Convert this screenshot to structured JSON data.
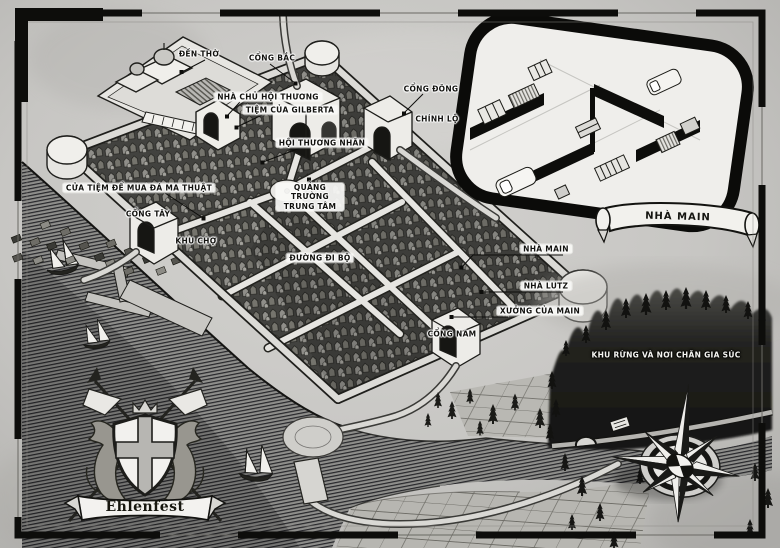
{
  "map": {
    "title_banner": "Ehlenfest",
    "inset_banner": "NHÀ MAIN",
    "labels": {
      "temple": "ĐỀN THỜ",
      "north_gate": "CỔNG BẮC",
      "guildmaster_house": "NHÀ CHỦ HỘI THƯƠNG",
      "gilberta_shop": "TIỆM CỦA GILBERTA",
      "merchant_guild": "HỘI THƯƠNG NHÂN",
      "east_gate": "CỔNG ĐÔNG",
      "main_road": "CHÍNH LỘ",
      "magic_stone_shop": "CỬA TIỆM ĐỂ MUA ĐÁ MA THUẬT",
      "west_gate": "CỔNG TÂY",
      "market": "KHU CHỢ",
      "central_plaza": "QUẢNG TRƯỜNG TRUNG TÂM",
      "walking_street": "ĐƯỜNG ĐI BỘ",
      "main_house": "NHÀ MAIN",
      "lutz_house": "NHÀ LUTZ",
      "main_workshop": "XƯỞNG CỦA MAIN",
      "south_gate": "CỔNG NAM",
      "forest": "KHU RỪNG VÀ NƠI CHĂN GIA SÚC"
    },
    "colors": {
      "paper": "#c7c6c3",
      "ink": "#131310",
      "forest": "#161614",
      "river": "#8e8e8b",
      "highlight": "#f2f1ed"
    }
  }
}
